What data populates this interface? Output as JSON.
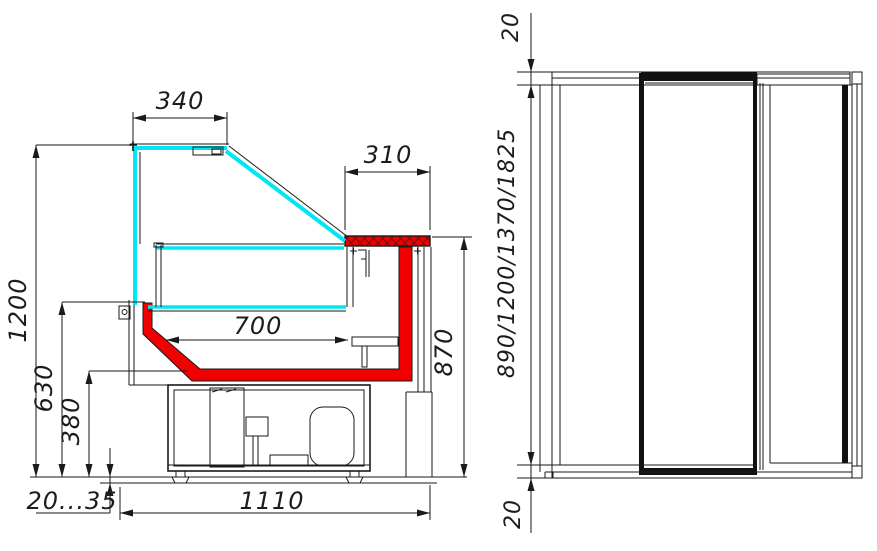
{
  "drawing": {
    "title": "refrigerated display case technical drawing",
    "views": {
      "left": "cross-section view",
      "right": "front view"
    },
    "dims": {
      "d340": "340",
      "d310": "310",
      "d1200": "1200",
      "d630": "630",
      "d380": "380",
      "d700": "700",
      "d870": "870",
      "d1110": "1110",
      "dFoot": "20...35",
      "dTop20": "20",
      "dLengths": "890/1200/1370/1825",
      "dBottom20": "20"
    },
    "colors": {
      "glass": "#00e6f2",
      "red": "#f20000",
      "hatch_line": "#7d0b0b",
      "line": "#1a1a1a",
      "background": "#ffffff"
    }
  }
}
